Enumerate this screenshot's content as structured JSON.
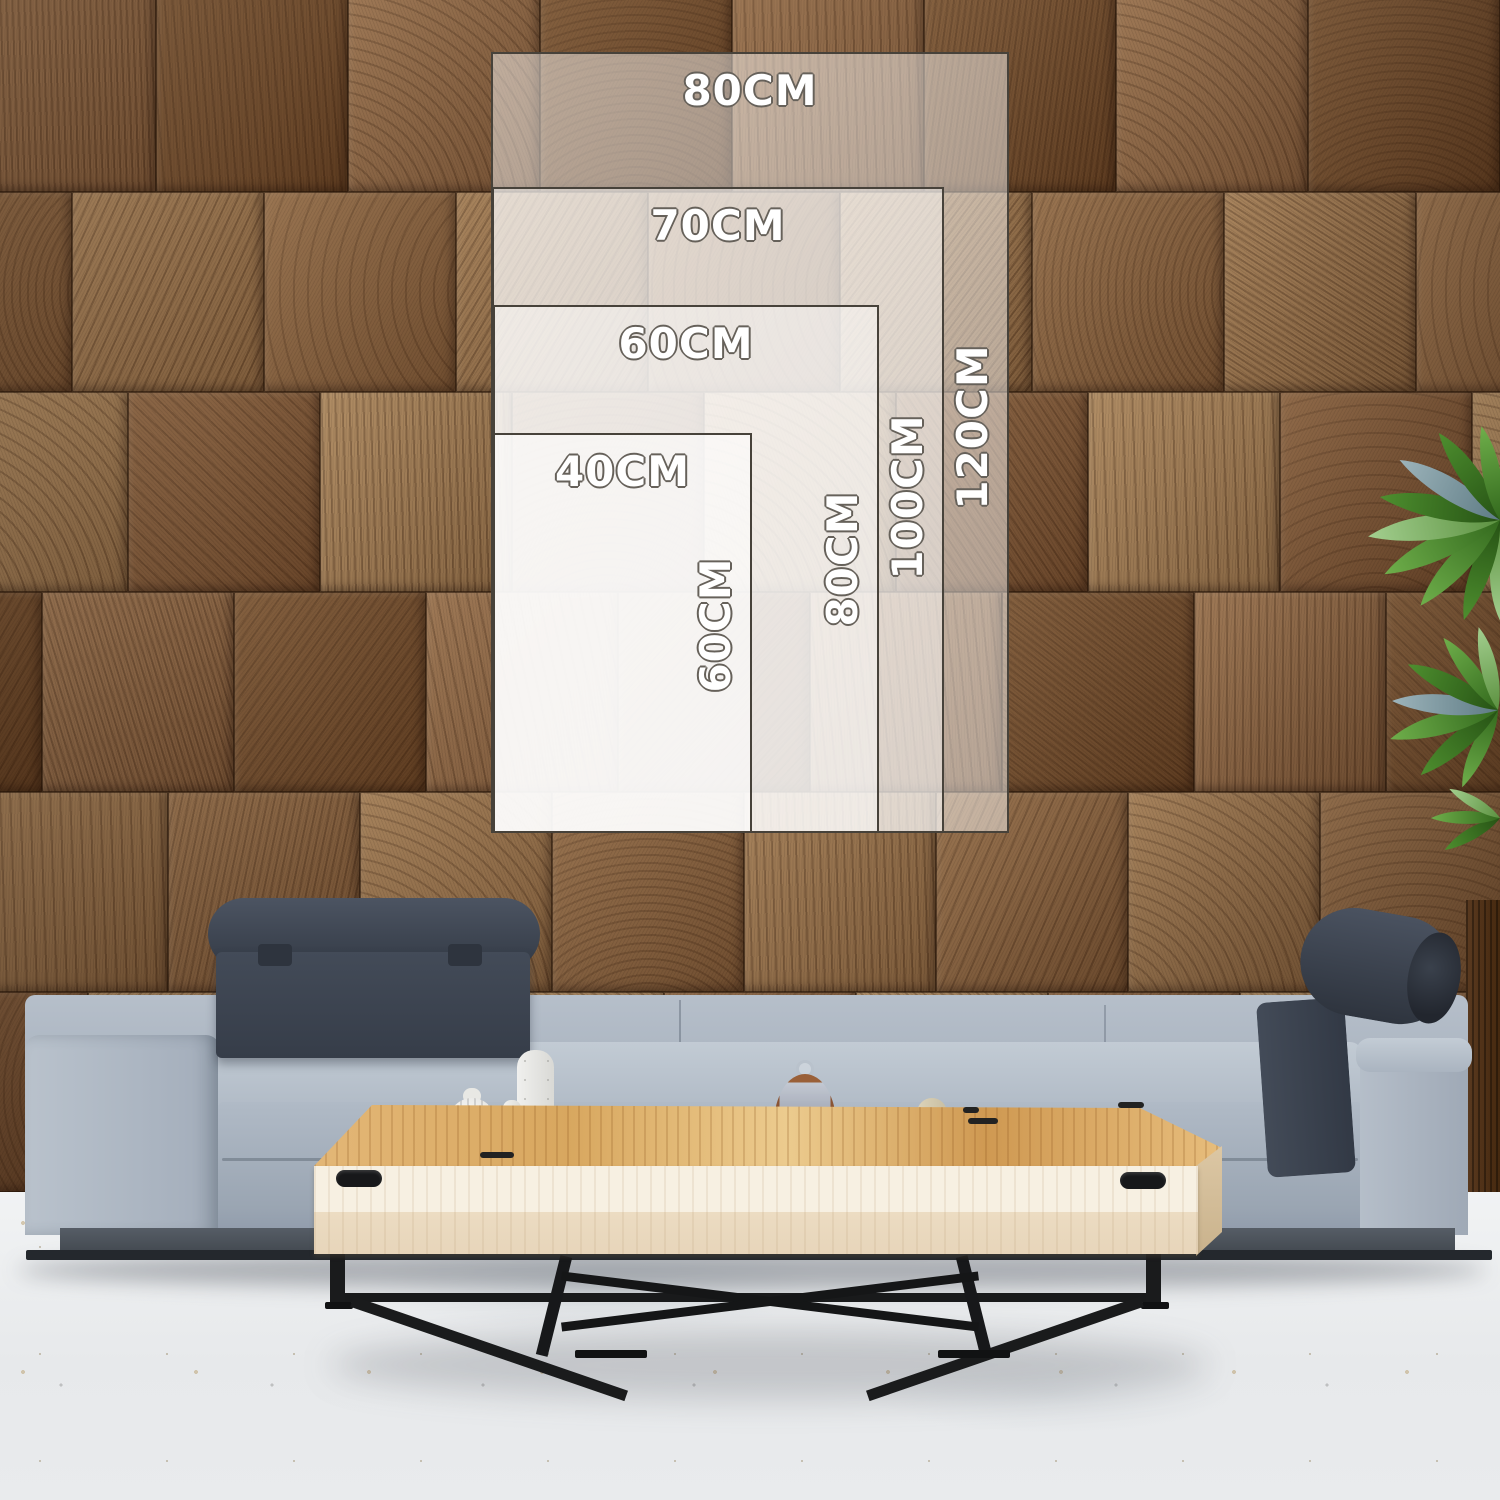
{
  "size_guide": {
    "sizes": [
      {
        "name": "80x120",
        "width_label": "80CM",
        "height_label": "120CM"
      },
      {
        "name": "70x100",
        "width_label": "70CM",
        "height_label": "100CM"
      },
      {
        "name": "60x80",
        "width_label": "60CM",
        "height_label": "80CM"
      },
      {
        "name": "40x60",
        "width_label": "40CM",
        "height_label": "60CM"
      }
    ]
  },
  "palette": {
    "overlay_fill": "#FFFFFF",
    "overlay_border": "#47423A",
    "label_fill": "#FFFFFF",
    "label_outline": "#66615A",
    "wall_wood": "#8A6443",
    "sofa_fabric": "#A9B3C0",
    "headrest_fabric": "#3D4450",
    "table_top_wood": "#DDAE68",
    "table_front_wood": "#F2E9D8",
    "metal_legs": "#1A1B1C",
    "floor": "#EDEFF1",
    "plant_green": "#57942F"
  }
}
